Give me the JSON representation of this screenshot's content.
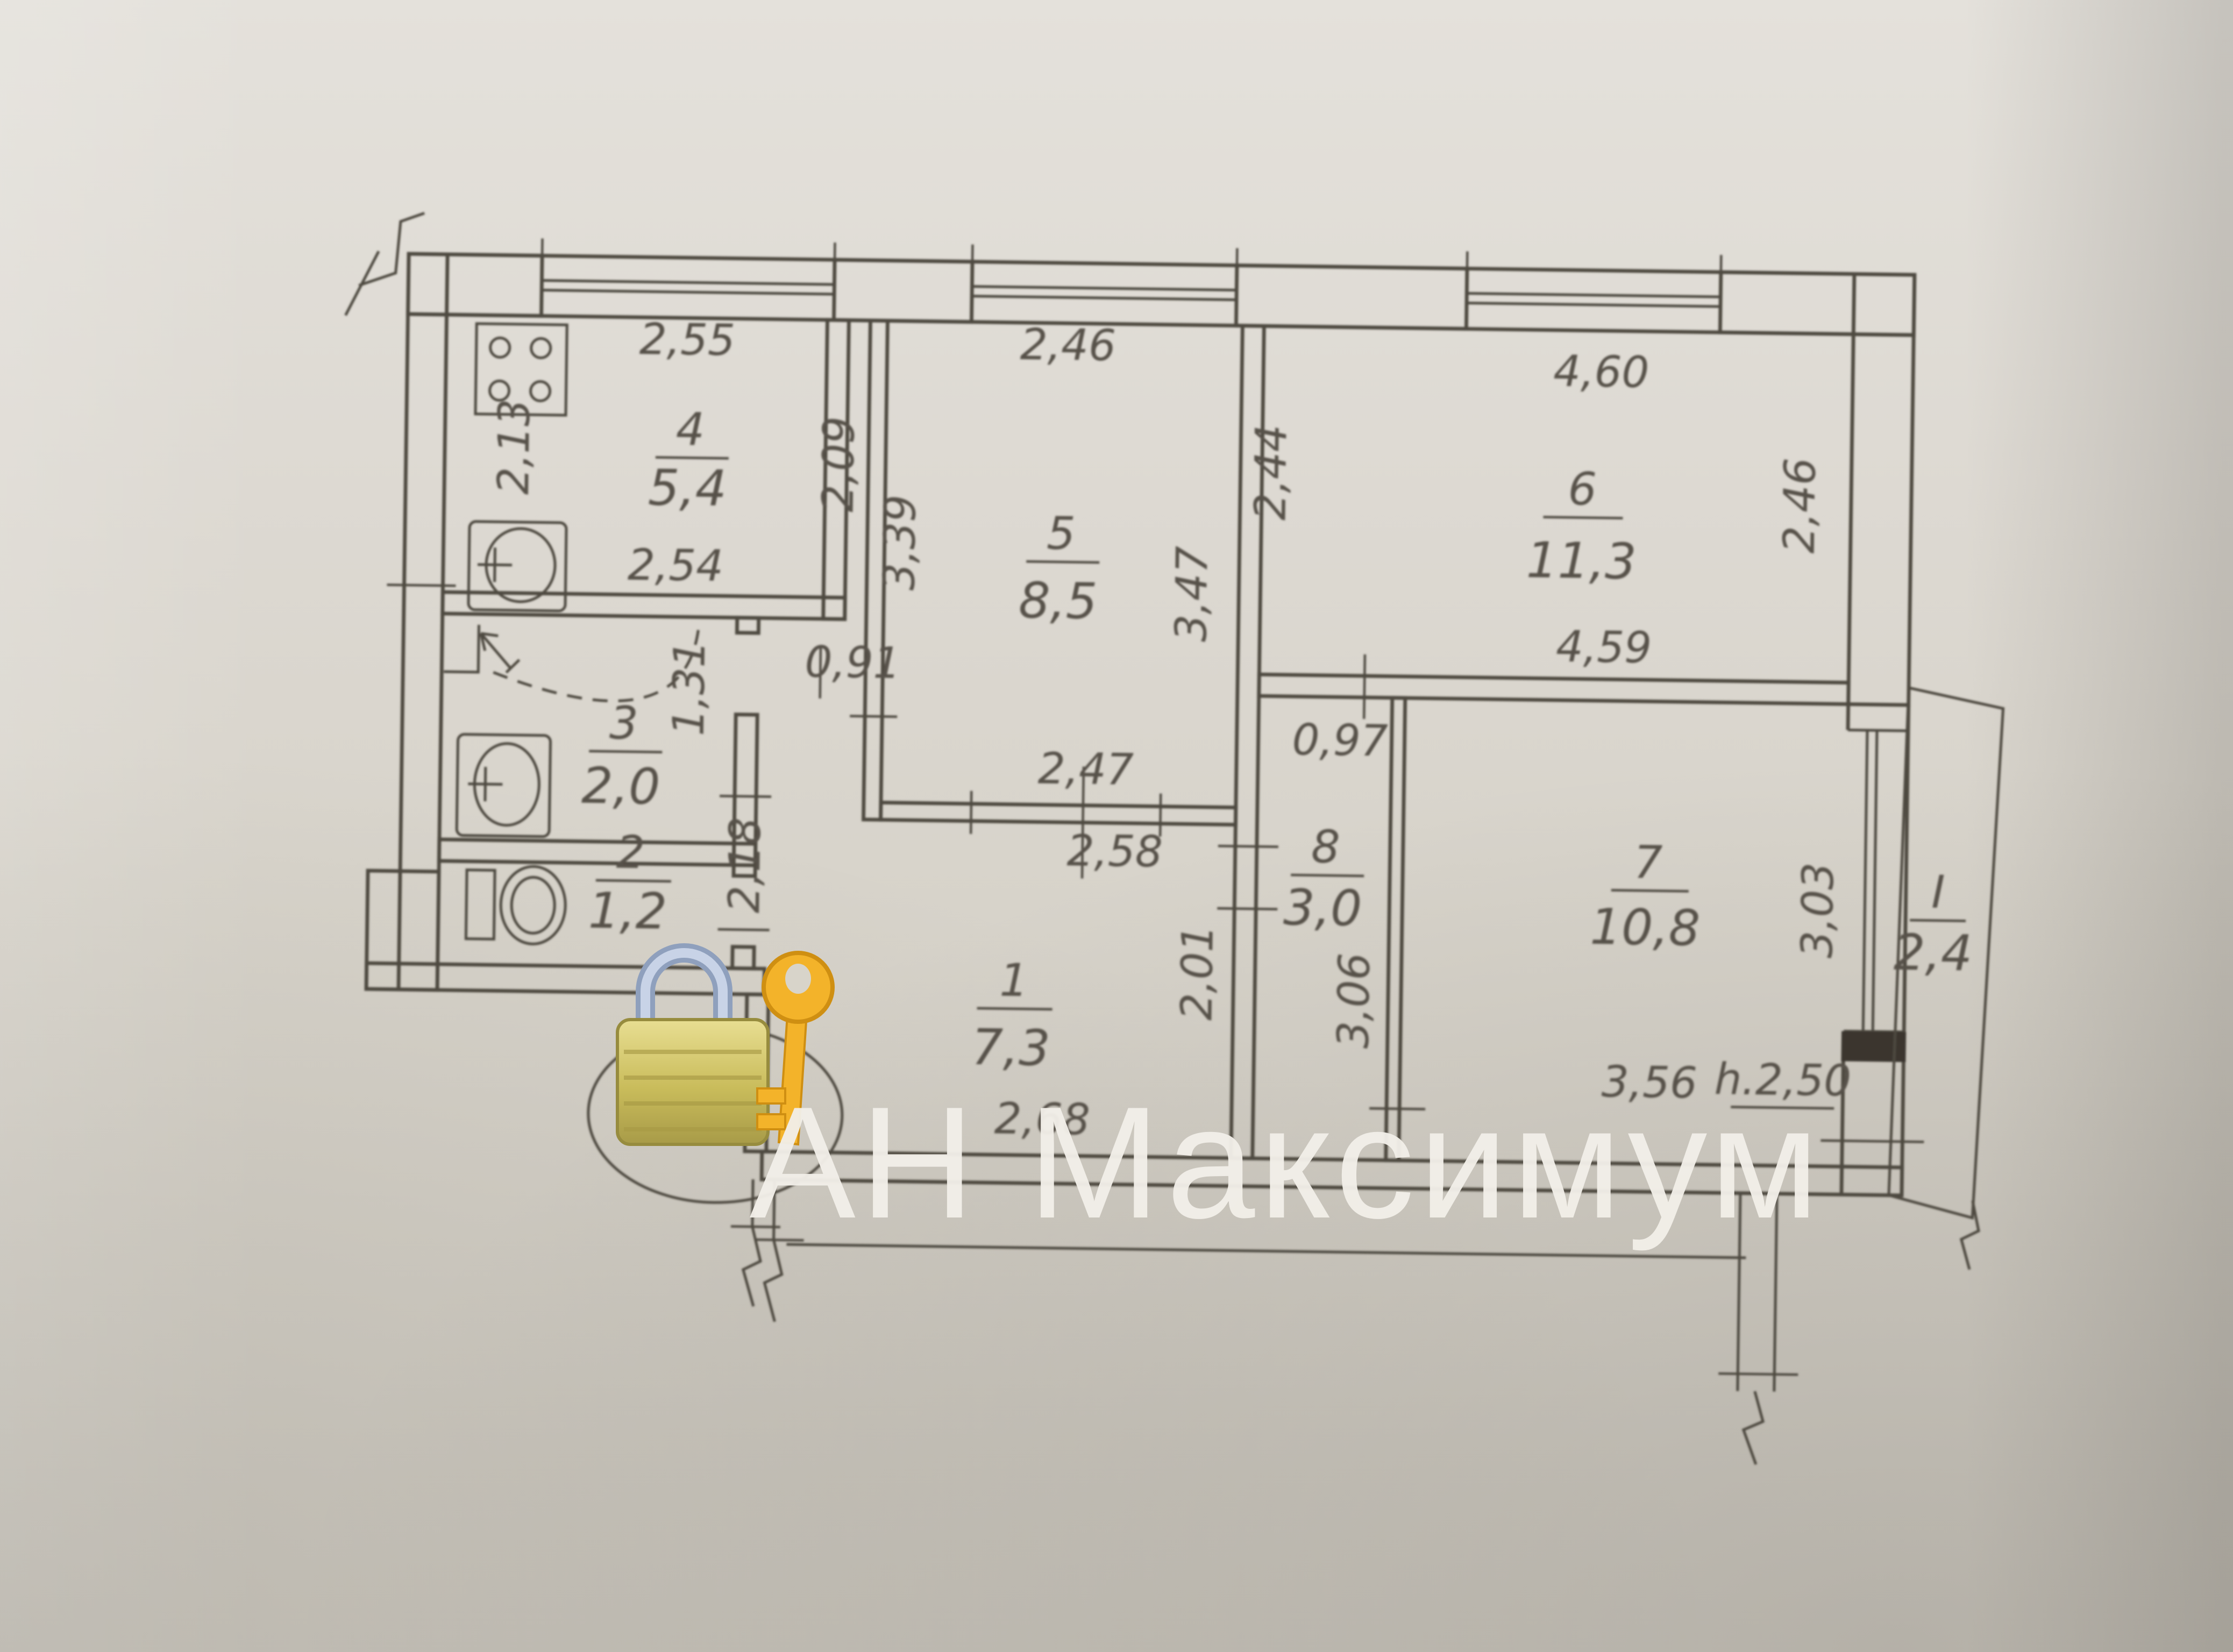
{
  "watermark": {
    "text": "АН Максимум",
    "color": "#f2efe9"
  },
  "colors": {
    "paper": "#d7d3ca",
    "ink": "#4e483f",
    "dimension_text": "#57514a",
    "balcony_sill": "#3a352e",
    "lock_body_gold": "#cfc26a",
    "key_gold": "#f3b32a",
    "shackle_silver": "#b9c6dd"
  },
  "rooms": {
    "r1": {
      "number": "1",
      "area": "7,3"
    },
    "r2": {
      "number": "2",
      "area": "1,2"
    },
    "r3": {
      "number": "3",
      "area": "2,0"
    },
    "r4": {
      "number": "4",
      "area": "5,4"
    },
    "r5": {
      "number": "5",
      "area": "8,5"
    },
    "r6": {
      "number": "6",
      "area": "11,3"
    },
    "r7": {
      "number": "7",
      "area": "10,8"
    },
    "r8": {
      "number": "8",
      "area": "3,0"
    },
    "balcony": {
      "number": "I",
      "area": "2,4"
    }
  },
  "dimensions": {
    "kitchen_width_top": "2,55",
    "kitchen_depth_left": "2,13",
    "kitchen_width_bottom": "2,54",
    "room5_width_top": "2,46",
    "room5_left_outer": "2,09",
    "room5_depth_left": "3,39",
    "room5_depth_right": "3,47",
    "room5_right_outer": "2,44",
    "room6_width_top": "4,60",
    "room6_depth_right": "2,46",
    "room6_width_bottom": "4,59",
    "passage_width": "0,91",
    "bath_depth_right": "1,31",
    "hall_depth_left": "2,18",
    "opening_width_top": "2,47",
    "opening_width_bottom": "2,58",
    "hall_depth_right": "2,01",
    "hall_width_bottom": "2,68",
    "room8_width_top": "0,97",
    "room8_depth_left": "3,06",
    "room7_width_bottom": "3,56",
    "room7_depth_right": "3,03",
    "ceiling_height": "h.2,50"
  }
}
